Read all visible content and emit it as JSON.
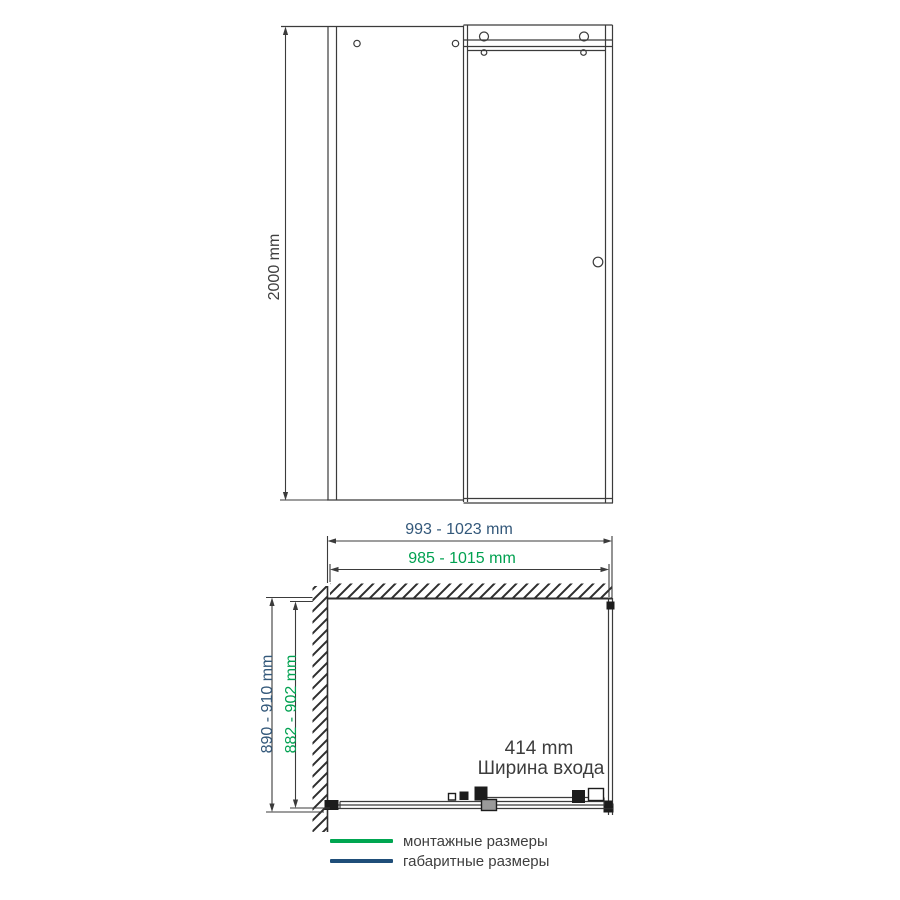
{
  "front_view": {
    "height_dimension": "2000 mm"
  },
  "plan_view": {
    "overall_width": "993 - 1023 mm",
    "mounting_width": "985 - 1015 mm",
    "overall_depth": "890 - 910 mm",
    "mounting_depth": "882 - 902 mm",
    "entry_width_value": "414 mm",
    "entry_width_caption": "Ширина входа"
  },
  "legend": {
    "items": [
      {
        "label": "монтажные размеры",
        "color": "#00A651"
      },
      {
        "label": "габаритные размеры",
        "color": "#1F4E79"
      }
    ]
  },
  "colors": {
    "mounting_dimension_text": "#00A150",
    "overall_dimension_text": "#33587A",
    "drawing_line": "#3B3B3B"
  }
}
